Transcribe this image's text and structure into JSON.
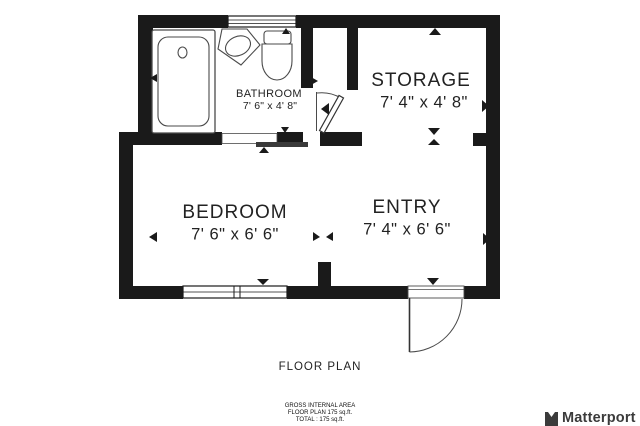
{
  "title": "FLOOR PLAN",
  "rooms": [
    {
      "id": "bathroom",
      "name": "BATHROOM",
      "dims": "7' 6\" x 4' 8\""
    },
    {
      "id": "storage",
      "name": "STORAGE",
      "dims": "7' 4\" x 4' 8\""
    },
    {
      "id": "bedroom",
      "name": "BEDROOM",
      "dims": "7' 6\" x 6' 6\""
    },
    {
      "id": "entry",
      "name": "ENTRY",
      "dims": "7' 4\" x 6' 6\""
    }
  ],
  "footer": {
    "line1": "GROSS INTERNAL AREA",
    "line2": "FLOOR PLAN 175 sq.ft.",
    "line3": "TOTAL :  175 sq.ft."
  },
  "brand": {
    "name": "Matterport"
  },
  "colors": {
    "wall": "#1a1a1a",
    "fixture_line": "#4a4a4a",
    "background": "#ffffff",
    "text": "#222222",
    "brand_text": "#3b3b3b"
  }
}
